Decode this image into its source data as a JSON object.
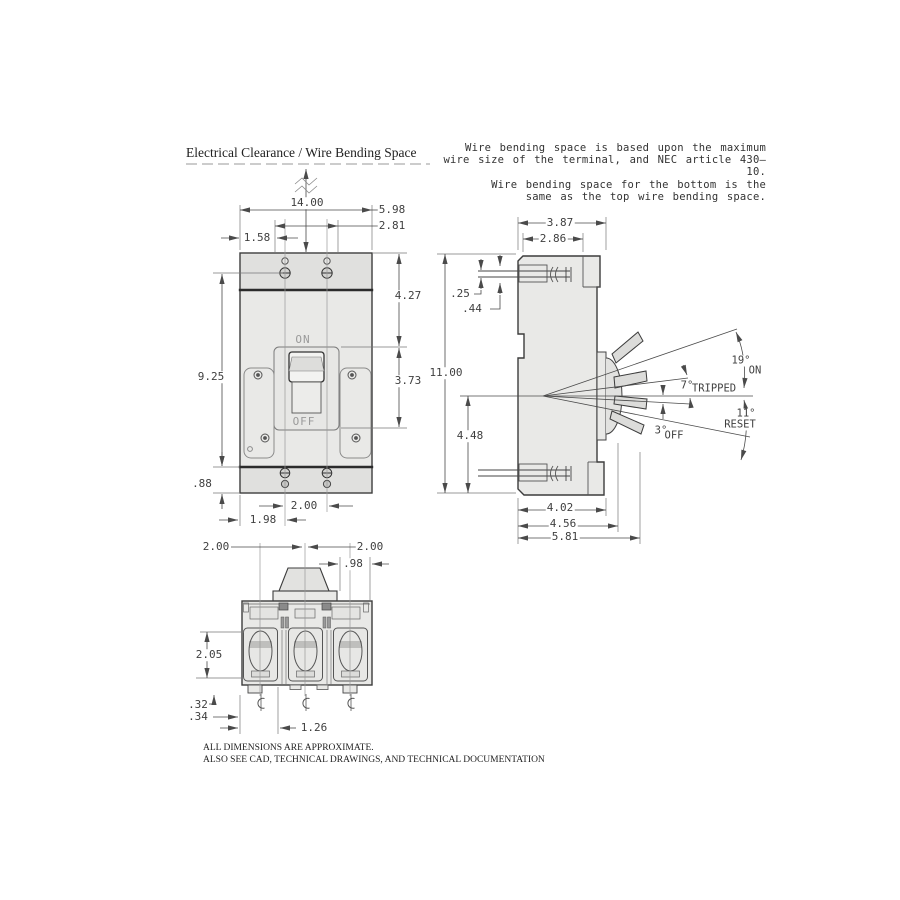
{
  "header": {
    "title": "Electrical Clearance / Wire Bending Space",
    "note_lines": [
      "Wire bending space is based upon the maximum",
      "wire size of the terminal, and NEC article 430–10.",
      "Wire bending space for the bottom is the",
      "same as the top wire bending space."
    ]
  },
  "front_view": {
    "handle_labels": {
      "on": "ON",
      "off": "OFF"
    },
    "dims": {
      "clearance_top": "14.00",
      "overall_width": "5.98",
      "recess_width": "2.81",
      "edge_to_recess": "1.58",
      "top_to_handle": "4.27",
      "mounting_height": "9.25",
      "handle_span": "3.73",
      "base_strip": ".88",
      "pole_spacing": "2.00",
      "edge_to_pole": "1.98"
    }
  },
  "side_view": {
    "dims": {
      "top_depth": "3.87",
      "terminal_depth": "2.86",
      "terminal_plate_gap": ".25",
      "terminal_opening": ".44",
      "overall_height": "11.00",
      "handle_center_to_base": "4.48",
      "body_depth": "4.02",
      "trim_depth": "4.56",
      "overall_depth": "5.81"
    },
    "handle_positions": [
      {
        "angle": "19°",
        "label": "ON"
      },
      {
        "angle": "7°",
        "label": "TRIPPED"
      },
      {
        "angle": "3°",
        "label": "OFF"
      },
      {
        "angle": "11°",
        "label": "RESET"
      }
    ]
  },
  "bottom_view": {
    "dims": {
      "pole_spacing_left": "2.00",
      "pole_spacing_right": "2.00",
      "handle_offset": ".98",
      "terminal_depth": "2.05",
      "foot_height": ".32",
      "foot_inset": ".34",
      "edge_to_lug": "1.26"
    },
    "centerline_symbol_name": "centerline-icon"
  },
  "footer": {
    "line1": "ALL DIMENSIONS ARE APPROXIMATE.",
    "line2": "ALSO SEE CAD, TECHNICAL DRAWINGS, AND TECHNICAL DOCUMENTATION"
  },
  "colors": {
    "body_fill": "#e9e9e7",
    "strip_fill": "#e0e0de",
    "outline": "#3c3c3c",
    "dim_line": "#4a4a4a",
    "dim_text": "#3f3f3f",
    "muted_label": "#9a9a9a"
  }
}
